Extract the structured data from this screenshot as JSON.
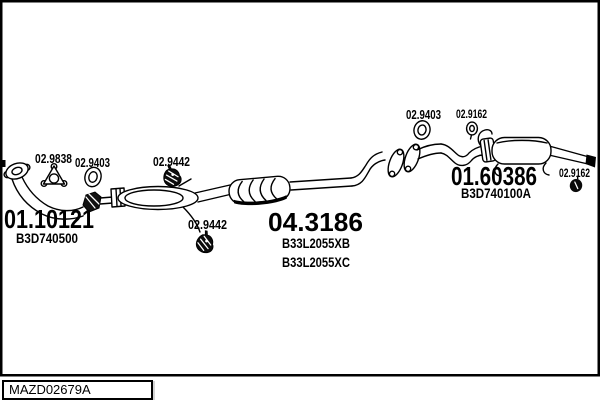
{
  "diagram": {
    "type": "exhaust-system-parts-diagram",
    "drawing_code": "MAZD02679A",
    "colors": {
      "line": "#000000",
      "background": "#ffffff"
    },
    "parts": {
      "front_pipe": {
        "code": "01.10121",
        "oe": "B3D740500"
      },
      "centre_muffler": {
        "code": "04.3186",
        "oe1": "B33L2055XB",
        "oe2": "B33L2055XC"
      },
      "rear_muffler": {
        "code": "01.60386",
        "oe": "B3D740100A"
      },
      "gasket_front": {
        "code": "02.9838"
      },
      "ring_gasket_front": {
        "code": "02.9403"
      },
      "hanger_centre_1": {
        "code": "02.9442"
      },
      "hanger_centre_2": {
        "code": "02.9442"
      },
      "ring_gasket_rear": {
        "code": "02.9403"
      },
      "hanger_rear_inlet": {
        "code": "02.9162"
      },
      "hanger_tailpipe": {
        "code": "02.9162"
      }
    }
  }
}
